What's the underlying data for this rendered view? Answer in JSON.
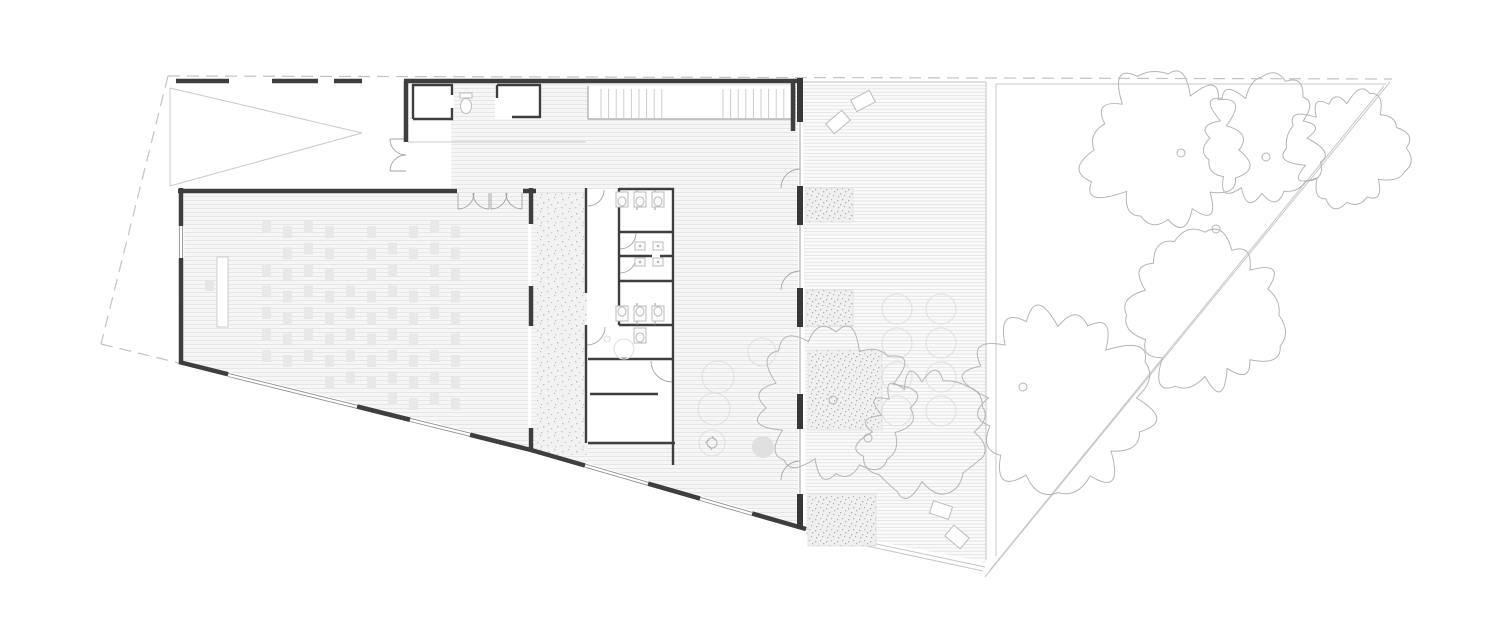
{
  "drawing": {
    "background": "#ffffff",
    "kind": "architectural-floor-plan"
  },
  "colors": {
    "wall": "#3e3e3e",
    "pier": "#383838",
    "thin": "#8f8f8f",
    "glass": "#a8a8a8",
    "lite": "#c9c9c9",
    "deckedge": "#c6c6c6",
    "dash": "#c3c3c3",
    "arc": "#a3a3a3",
    "hatch": "#e4e4e4",
    "floor": "#f6f6f6",
    "deckline": "#e1e1e1",
    "deckfloor": "#fafafa",
    "terrbg": "#f2f2f2",
    "terrdot": "#c2c2c2",
    "spkbg": "#f0f0f0",
    "spkdot": "#b2b2b2",
    "tree": "#b5b5b5",
    "seat": "#e8e8e8",
    "faint": "#e0e0e0",
    "fixture": "#bcbcbc"
  },
  "plan": {
    "seating": {
      "x0": 262,
      "dx": 21,
      "cols": 10,
      "y0": 221,
      "dy": 21.5,
      "w": 9,
      "h": 12,
      "stagger": 5,
      "wall": {
        "x": 180,
        "y": 363,
        "slope": 0.2473
      },
      "margin": 15,
      "skip": [
        [
          4,
          0
        ],
        [
          4,
          1
        ],
        [
          4,
          2
        ],
        [
          0,
          1
        ],
        [
          7,
          2
        ],
        [
          2,
          7
        ],
        [
          6,
          0
        ],
        [
          8,
          5
        ]
      ]
    },
    "stair": {
      "yTop": 89,
      "yBot": 118,
      "flights": [
        [
          601,
          663
        ],
        [
          723,
          789
        ]
      ],
      "step": 7.6
    },
    "east_facade_piers": [
      [
        78,
        122
      ],
      [
        186,
        225
      ],
      [
        288,
        327
      ],
      [
        394,
        429
      ],
      [
        494,
        529
      ]
    ],
    "hall_right_piers": [
      [
        188,
        224
      ],
      [
        286,
        326
      ],
      [
        428,
        451
      ]
    ],
    "trees": [
      {
        "cx": 1168,
        "cy": 150,
        "r": 80,
        "seed": 7
      },
      {
        "cx": 1262,
        "cy": 138,
        "r": 60,
        "seed": 23
      },
      {
        "cx": 1347,
        "cy": 148,
        "r": 58,
        "seed": 41
      },
      {
        "cx": 1205,
        "cy": 315,
        "r": 78,
        "seed": 11
      },
      {
        "cx": 1058,
        "cy": 398,
        "r": 92,
        "seed": 55
      },
      {
        "cx": 922,
        "cy": 432,
        "r": 62,
        "seed": 29
      },
      {
        "cx": 836,
        "cy": 408,
        "r": 76,
        "seed": 63
      }
    ],
    "trunks": [
      [
        1181,
        153
      ],
      [
        1266,
        157
      ],
      [
        1216,
        229
      ],
      [
        1023,
        387
      ],
      [
        833,
        400
      ],
      [
        868,
        438
      ]
    ],
    "deck_furniture": [
      {
        "x": 838,
        "y": 122,
        "w": 21,
        "h": 13,
        "rot": -40
      },
      {
        "x": 863,
        "y": 101,
        "w": 21,
        "h": 13,
        "rot": -28
      },
      {
        "x": 941,
        "y": 510,
        "w": 20,
        "h": 13,
        "rot": 18
      },
      {
        "x": 957,
        "y": 537,
        "w": 20,
        "h": 14,
        "rot": 40
      }
    ],
    "planters": [
      [
        806,
        188,
        47,
        34
      ],
      [
        806,
        290,
        47,
        36
      ],
      [
        808,
        350,
        74,
        80
      ],
      [
        808,
        494,
        68,
        52
      ]
    ],
    "deck_round_shrubs": {
      "cols": [
        897,
        941
      ],
      "rows": [
        309,
        343,
        377,
        411
      ],
      "r": 15
    },
    "tables": [
      {
        "cx": 718,
        "cy": 377,
        "r": 16
      },
      {
        "cx": 714,
        "cy": 409,
        "r": 16
      },
      {
        "cx": 762,
        "cy": 352,
        "r": 14
      }
    ],
    "filled_circles": [
      {
        "cx": 763,
        "cy": 447,
        "r": 11
      }
    ],
    "plant_symbol": {
      "cx": 712,
      "cy": 443,
      "r": 13
    },
    "toilets": [
      [
        622,
        192,
        1
      ],
      [
        640,
        192,
        1
      ],
      [
        658,
        192,
        1
      ],
      [
        622,
        321,
        -1
      ],
      [
        640,
        321,
        -1
      ],
      [
        658,
        321,
        -1
      ],
      [
        640,
        328,
        1
      ]
    ],
    "sinks": [
      [
        640,
        246
      ],
      [
        658,
        246
      ],
      [
        640,
        262
      ],
      [
        658,
        262
      ]
    ],
    "wc_fixture": {
      "x": 466,
      "y": 103
    },
    "shower": {
      "cx": 624,
      "cy": 349,
      "r": 10
    }
  }
}
